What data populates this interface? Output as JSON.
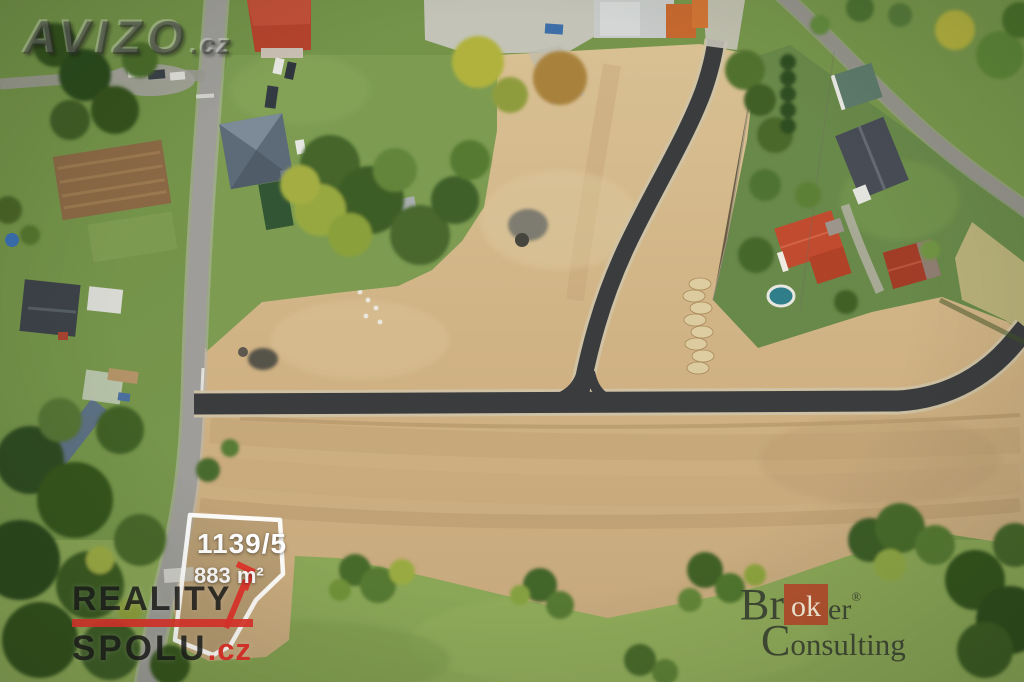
{
  "meta": {
    "type": "aerial-real-estate-photo",
    "description": "Drone aerial view of building plots for sale: newly paved dark asphalt access roads through graded sandy earthworks, a village street on the left, family houses with red and slate roofs among gardens on the right, green fields and trees around. Plot 1139/5 (883 m²) is outlined in white next to the street."
  },
  "watermark": {
    "main": "AVIZO",
    "suffix": ".cz"
  },
  "plot": {
    "number": "1139/5",
    "area": "883 m²"
  },
  "agency": {
    "line1": "REALITY",
    "line2": "SPOLU",
    "suffix": ".cz",
    "accent_color": "#e0332b",
    "text_color": "#181818"
  },
  "broker": {
    "part1": "Br",
    "highlight": "ok",
    "part2": "er",
    "registered": "®",
    "line2": "Consulting",
    "square_color": "#b54a2b",
    "text_color": "#343a2e"
  },
  "palette": {
    "grass": "#76954c",
    "field": "#87a254",
    "sand": "#d2b98c",
    "asphalt_new": "#3b3c3e",
    "street_asphalt": "#9e9d99",
    "roof_red": "#c14b2e",
    "roof_slate": "#474c55",
    "pool_water": "#2f7e8a",
    "plot_outline": "#ffffff",
    "arrow_red": "#e0332b"
  }
}
